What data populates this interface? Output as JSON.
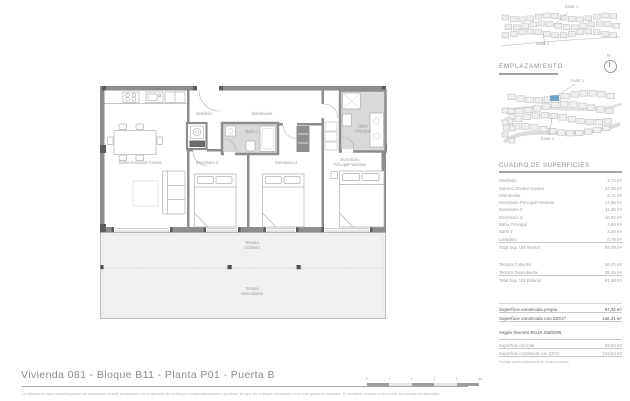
{
  "document": {
    "title": "Vivienda 081 - Bloque B11 - Planta P01 - Puerta B",
    "disclaimer": "La información aquí contenida puede ser modificada durante el transcurso de la ejecución de la obra por exigencias técnicas y jurídicas, sin que ello implique menoscabo en el nivel global de calidades. El mobiliario, incluido el de cocina, es meramente decorativo."
  },
  "scalebar": {
    "labels": [
      "0",
      "1",
      "2",
      "3",
      "4",
      "5m"
    ]
  },
  "sidebar": {
    "emplazamiento_heading": "EMPLAZAMIENTO",
    "fase1": "FASE 1",
    "fase2": "FASE 2",
    "compass_n": "N",
    "highlight_color": "#6fa3c8"
  },
  "plan": {
    "colors": {
      "wall": "#8d8d8d",
      "wall_dark": "#5c5c5c",
      "bathroom_fill": "#d9d9d9",
      "terrace_fill": "#f0f1ee"
    },
    "labels": {
      "vestibulo": "Vestíbulo",
      "distribuidor": "Distribuidor",
      "salon": "Salón-Comedor-Cocina",
      "dorm3": "Dormitorio 3",
      "dorm2": "Dormitorio 2",
      "bano2": "Baño 2",
      "banoppal_1": "Baño",
      "banoppal_2": "Principal",
      "dormppal_1": "Dormitorio",
      "dormppal_2": "Principal+Vestidor",
      "terraza_cub_1": "Terraza",
      "terraza_cub_2": "Cubierta",
      "terraza_desc_1": "Terraza",
      "terraza_desc_2": "Descubierta"
    }
  },
  "cuadro": {
    "heading": "CUADRO DE SUPERFICIES",
    "interior": {
      "rows": [
        [
          "Vestíbulo",
          "2,74 m²"
        ],
        [
          "Salón-Comedor-Cocina",
          "27,06 m²"
        ],
        [
          "Distribuidor",
          "5,72 m²"
        ],
        [
          "Dormitorio Principal+Vestidor",
          "17,55 m²"
        ],
        [
          "Dormitorio 2",
          "11,85 m²"
        ],
        [
          "Dormitorio 3",
          "10,92 m²"
        ],
        [
          "Baño Principal",
          "4,69 m²"
        ],
        [
          "Baño 2",
          "3,39 m²"
        ],
        [
          "Lavadero",
          "0,79 m²"
        ]
      ],
      "total": [
        "Total Sup. Útil Interior",
        "84,09 m²"
      ]
    },
    "exterior": {
      "rows": [
        [
          "Terraza Cubierta",
          "26,43 m²"
        ],
        [
          "Terraza Descubierta",
          "35,25 m²"
        ]
      ],
      "total": [
        "Total Sup. Útil Exterior",
        "61,68 m²"
      ]
    },
    "construida": {
      "rows": [
        [
          "Superficie construida propia",
          "97,34 m²"
        ],
        [
          "Superficie construida con ZZCC*",
          "146,31 m²"
        ]
      ]
    },
    "decreto": {
      "header": "Según Decreto BOJA 218/2005",
      "rows": [
        [
          "Superficie útil total",
          "93,83 m²"
        ],
        [
          "Superficie construida con ZZCC",
          "153,54 m²"
        ]
      ]
    },
    "footnote": "*Incluye parte proporcional de zonas comunes"
  }
}
